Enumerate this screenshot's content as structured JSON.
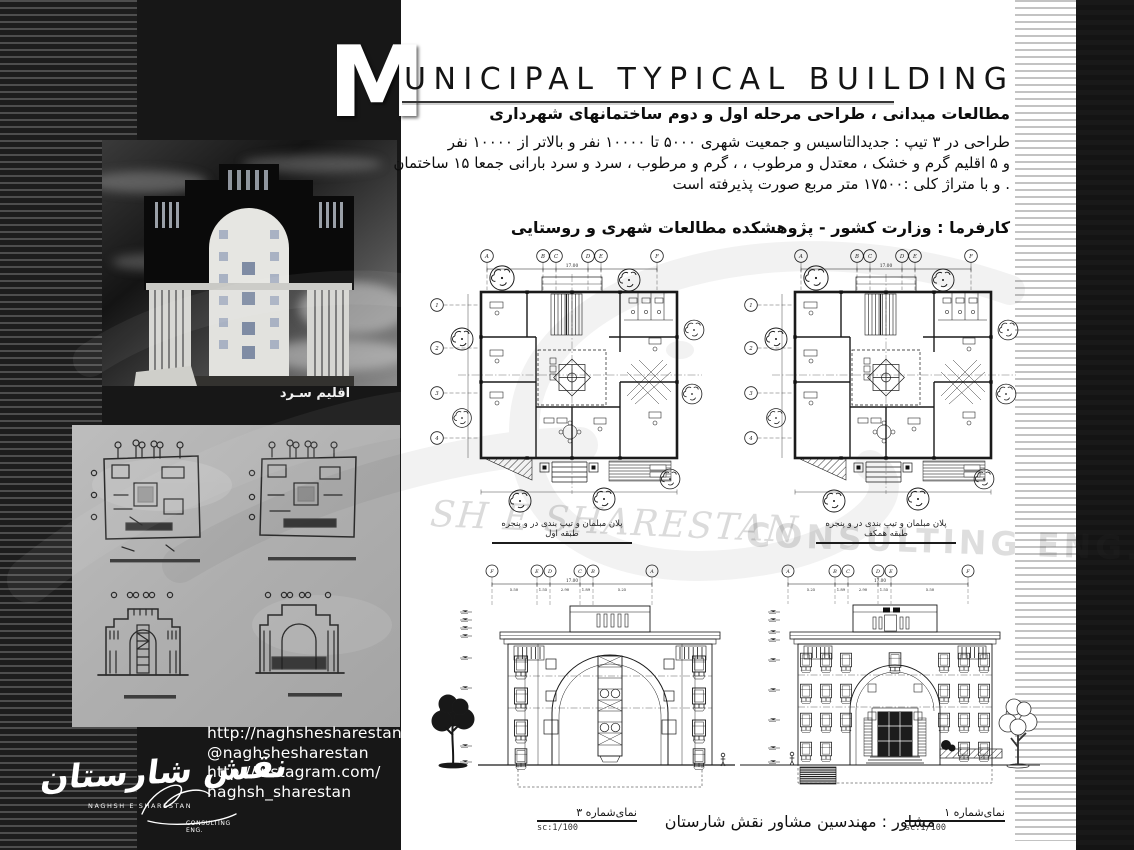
{
  "header": {
    "initial": "M",
    "rest": "UNICIPAL TYPICAL BUILDING"
  },
  "intro": {
    "heading": "مطالعات میدانی ، طراحی مرحله اول و دوم ساختمانهای  شهرداری",
    "body1": "طراحی در ۳ تیپ : جدیدالتاسیس و جمعیت شهری ۵۰۰۰ تا ۱۰۰۰۰ نفر و بالاتر از ۱۰۰۰۰ نفر",
    "body2": "و ۵ اقلیم گرم و خشک ، معتدل و مرطوب ، ، گرم و مرطوب ، سرد و سرد بارانی جمعا ۱۵ ساختمان",
    "body3": ". و با متراژ کلی  :۱۷۵۰۰ متر مربع صورت پذیرفته است",
    "client": "کارفرما : وزارت کشور - پژوهشکده مطالعات شهری و روستایی"
  },
  "sidebar": {
    "render_caption": "اقلیم سـرد",
    "contact": {
      "website": "http://naghshesharestan.com",
      "handle": "@naghshesharestan",
      "instagram_url": "http://instagram.com/",
      "instagram_user": "naghsh_sharestan"
    },
    "logo": {
      "farsi": "نقش شارستان",
      "latin": "NAGHSH  E  SHARESTAN",
      "consulting": "CONSULTING ENG."
    }
  },
  "drawings": {
    "grid_letters": [
      "A",
      "B",
      "C",
      "D",
      "E",
      "F"
    ],
    "grid_letters_rev": [
      "F",
      "E",
      "D",
      "C",
      "B",
      "A"
    ],
    "grid_rows": [
      "1",
      "2",
      "3",
      "4"
    ],
    "total_dim": "17.00",
    "elev3_dims": [
      "5.50",
      "1.55",
      "2.90",
      "1.89",
      "5.25"
    ],
    "elev1_dims": [
      "5.25",
      "1.89",
      "2.90",
      "1.55",
      "5.50"
    ],
    "plan1_caption": "پلان مبلمان و تیپ بندی در و پنجره طبقه اول",
    "plan2_caption": "پلان مبلمان و تیپ بندی در و پنجره طبقه همکف",
    "elev3_label": "نمای‌شماره ۳",
    "elev1_label": "نمای‌شماره ۱",
    "scale_label": "sc:1/100"
  },
  "footer": {
    "consultant": "مشاور : مهندسین مشاور نقش شارستان"
  },
  "watermarks": {
    "serif_text": "SH E  SHARESTAN",
    "consulting_text": "CONSULTING  ENG."
  },
  "colors": {
    "sidebar_bg": "#171717",
    "right_bar": "#181818",
    "paper": "#ffffff",
    "sketch_paper": "#b3b3b3",
    "ink": "#1a1a1a"
  }
}
